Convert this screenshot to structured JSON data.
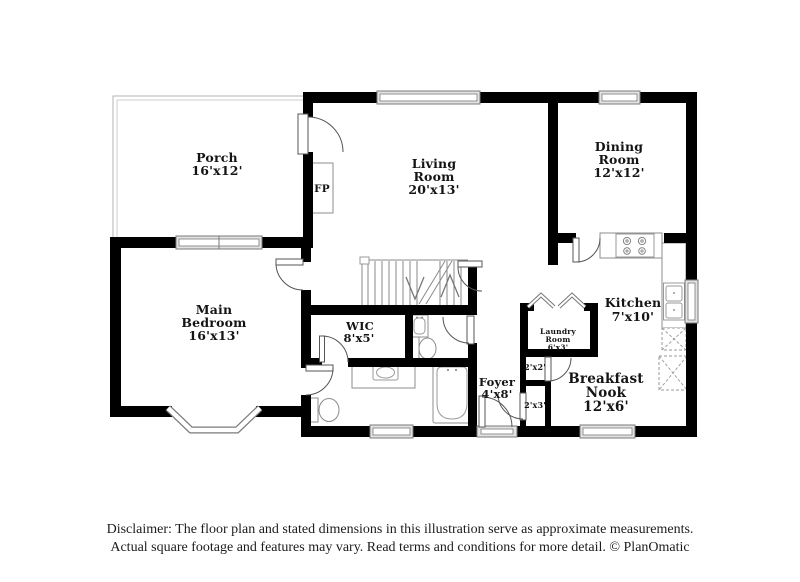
{
  "rooms": {
    "porch": {
      "lines": [
        "Porch",
        "16'x12'"
      ]
    },
    "living_room": {
      "lines": [
        "Living",
        "Room",
        "20'x13'"
      ]
    },
    "dining_room": {
      "lines": [
        "Dining",
        "Room",
        "12'x12'"
      ]
    },
    "main_bedroom": {
      "lines": [
        "Main",
        "Bedroom",
        "16'x13'"
      ]
    },
    "wic": {
      "lines": [
        "WIC",
        "8'x5'"
      ]
    },
    "kitchen": {
      "lines": [
        "Kitchen",
        "7'x10'"
      ]
    },
    "laundry_room": {
      "lines": [
        "Laundry",
        "Room",
        "6'x3'"
      ]
    },
    "foyer": {
      "lines": [
        "Foyer",
        "4'x8'"
      ]
    },
    "breakfast_nook": {
      "lines": [
        "Breakfast",
        "Nook",
        "12'x6'"
      ]
    },
    "closet_2x2": {
      "lines": [
        "2'x2'"
      ]
    },
    "closet_2x3": {
      "lines": [
        "2'x3'"
      ]
    },
    "fireplace": {
      "lines": [
        "FP"
      ]
    }
  },
  "disclaimer": {
    "line1": "Disclaimer: The floor plan and stated dimensions in this illustration serve as approximate measurements.",
    "line2": "Actual square footage and features may vary. Read terms and conditions for more detail. © PlanOmatic"
  },
  "colors": {
    "wall": "#000000",
    "label_text": "#141414",
    "fixture_outline": "#8c8c8c"
  }
}
